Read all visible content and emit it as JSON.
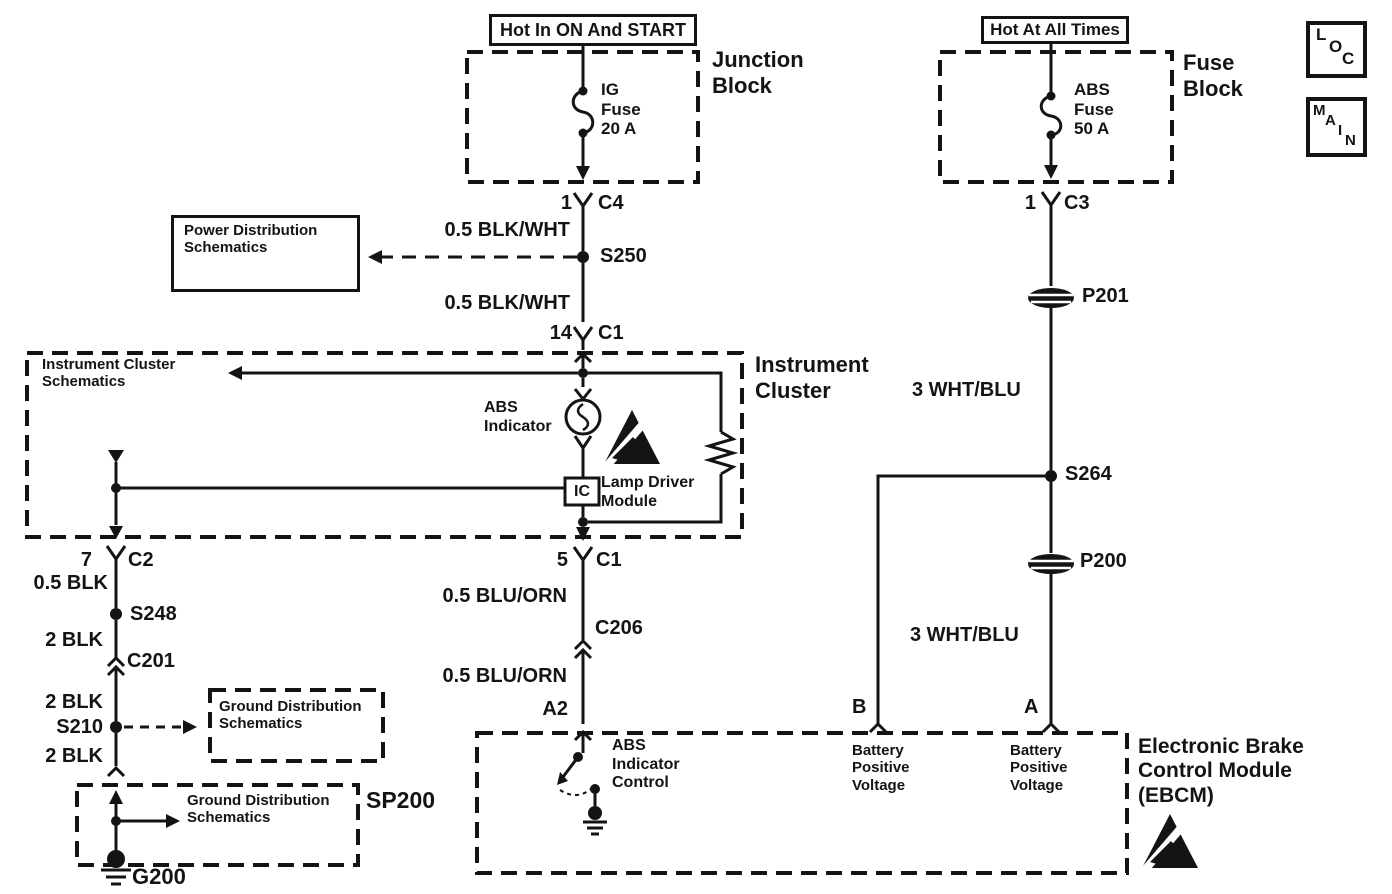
{
  "power_sources": {
    "left_box": "Hot In ON And START",
    "right_box": "Hot At All Times"
  },
  "corner_tags": {
    "loc": [
      "L",
      "O",
      "C"
    ],
    "main": [
      "M",
      "A",
      "I",
      "N"
    ]
  },
  "junction_block": {
    "label": "Junction\nBlock",
    "fuse": "IG\nFuse\n20 A"
  },
  "fuse_block": {
    "label": "Fuse\nBlock",
    "fuse": "ABS\nFuse\n50 A"
  },
  "instrument_cluster": {
    "label": "Instrument\nCluster",
    "ref": "Instrument Cluster\nSchematics",
    "abs_indicator": "ABS\nIndicator",
    "lamp_driver": "Lamp Driver\nModule",
    "ic_chip": "IC"
  },
  "ebcm": {
    "label": "Electronic Brake\nControl Module\n(EBCM)",
    "abs_indicator_control": "ABS\nIndicator\nControl",
    "battery_b": "Battery\nPositive\nVoltage",
    "battery_a": "Battery\nPositive\nVoltage",
    "pin_a2": "A2",
    "pin_b": "B",
    "pin_a": "A"
  },
  "references": {
    "power_distribution": "Power Distribution\nSchematics",
    "ground_distribution_1": "Ground Distribution\nSchematics",
    "ground_distribution_2": "Ground Distribution\nSchematics"
  },
  "connectors": {
    "c4_pin": "1",
    "c4": "C4",
    "c1_in_pin": "14",
    "c1_in": "C1",
    "c2_pin": "7",
    "c2": "C2",
    "c1_out_pin": "5",
    "c1_out": "C1",
    "c206": "C206",
    "c201": "C201",
    "c3_pin": "1",
    "c3": "C3"
  },
  "splices": {
    "s250": "S250",
    "s248": "S248",
    "s210": "S210",
    "s264": "S264",
    "sp200": "SP200"
  },
  "grommets": {
    "p201": "P201",
    "p200": "P200"
  },
  "ground": {
    "g200": "G200"
  },
  "wires": {
    "w1": "0.5 BLK/WHT",
    "w2": "0.5 BLK/WHT",
    "w3": "0.5 BLK",
    "w4": "2 BLK",
    "w5": "2 BLK",
    "w6": "2 BLK",
    "w7": "0.5 BLU/ORN",
    "w8": "0.5 BLU/ORN",
    "w9": "3 WHT/BLU",
    "w10": "3 WHT/BLU"
  }
}
